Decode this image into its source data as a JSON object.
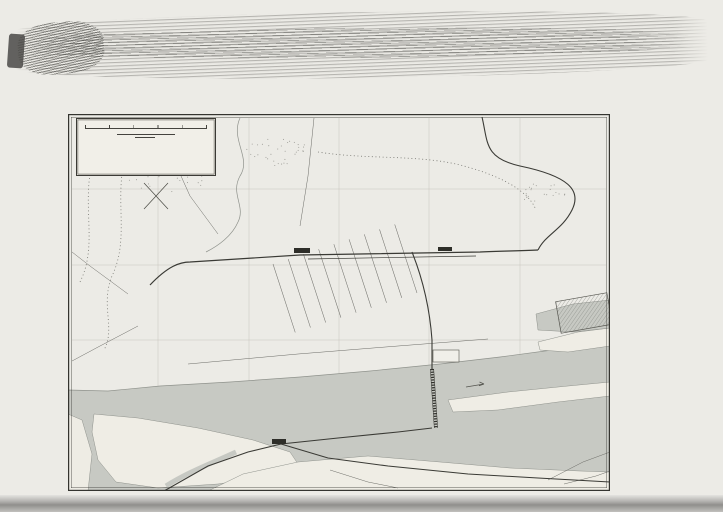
{
  "page": {
    "imprint": "Bibliographisches Institut in Leipzig."
  },
  "title_box": {
    "title": "UMGEBUNG v. MAINZ.",
    "scale_label": "Maßstab 1:25000",
    "scale_numbers": [
      "0",
      "200",
      "400",
      "600",
      "800",
      "1000"
    ],
    "scale_unit": "Mtr.",
    "kilometer_label": "1 Kilometer",
    "legend_tram": "Pferde- und Dampfstraßenbahn."
  },
  "border": {
    "top_letters": [
      "A",
      "B",
      "C",
      "D",
      "E",
      "F"
    ],
    "bottom_letters": [
      "A",
      "B",
      "C",
      "D",
      "E",
      "F"
    ],
    "left_numbers": [
      "1",
      "2",
      "3",
      "4",
      "5"
    ],
    "right_numbers": [
      "1",
      "2",
      "3",
      "4",
      "5"
    ],
    "top_label": "Zahlbach",
    "top_routes": [
      "n. Bretzenheim u. Marienborn",
      "n. Mombach",
      "n. Gonsenheim u. Finthen",
      "n. Budenheim"
    ],
    "bottom_routes": [
      "n. Frankfurt",
      "n. Wiesbaden u. Biebrich"
    ],
    "left_route": "n. Frankfurt u. Darmstadt"
  },
  "labels": [
    {
      "id": "zentral-bahnhof",
      "text": "Zentral-Bahnhof"
    },
    {
      "id": "gueter-bahnhof",
      "text": "Güter-Bahnhof"
    },
    {
      "id": "neustadt",
      "text": "Neustadt"
    },
    {
      "id": "gartenfeld",
      "text": "Gartenfeld"
    },
    {
      "id": "zitadelle",
      "text": "Zitadelle"
    },
    {
      "id": "theater",
      "text": "Theater"
    },
    {
      "id": "dom",
      "text": "Dom"
    },
    {
      "id": "rhein",
      "text": "RHEIN"
    },
    {
      "id": "strom",
      "text": "STROM"
    },
    {
      "id": "rhein-promenade",
      "text": "Rhein Promenade"
    },
    {
      "id": "trajekthof",
      "text": "Trajekthof"
    },
    {
      "id": "koeln-dampfer",
      "text": "Köln-Düsseldorfer Dampfer"
    },
    {
      "id": "niederl-dampfer",
      "text": "Niederländische Dampfer"
    },
    {
      "id": "eisenbruecke",
      "text": "Eisenbrücke"
    },
    {
      "id": "maar-aue",
      "text": "Maar-Aue"
    },
    {
      "id": "main",
      "text": "MAIN"
    },
    {
      "id": "peters-aue",
      "text": "Peters Aue"
    },
    {
      "id": "kastel",
      "text": "KASTEL"
    },
    {
      "id": "kastel-small",
      "text": "Kastel."
    },
    {
      "id": "taunus-bahnhof",
      "text": "Taunus Bahnh."
    },
    {
      "id": "kirche",
      "text": "Kirche"
    },
    {
      "id": "evang-k",
      "text": "Evang. K."
    },
    {
      "id": "frankfurter-thor",
      "text": "Frankfurter Thor"
    },
    {
      "id": "wiesbadener-thor",
      "text": "Wiesbadener Thor"
    },
    {
      "id": "sicherheitshafen-kastel",
      "text": "Sicherheitshafen"
    },
    {
      "id": "sicherheitshafen-mainz",
      "text": "Sicherheitshafen"
    },
    {
      "id": "floss-hafen",
      "text": "Sicherheits- und Floßhafen"
    },
    {
      "id": "ingelheimer-aue",
      "text": "Ingelheimer Aue"
    },
    {
      "id": "exerzier-platz",
      "text": "Exerzier Platz"
    },
    {
      "id": "hess-ludwigsbahn",
      "text": "Hessische Ludwigsbahn"
    },
    {
      "id": "hartenberg",
      "text": "Hartenberg"
    },
    {
      "id": "hartmuehle",
      "text": "Hartmühle"
    },
    {
      "id": "konserven-fabrik",
      "text": "Kgl. Konserven-Fabrik"
    },
    {
      "id": "mombacher-thor",
      "text": "Mombacher Thor"
    },
    {
      "id": "kaserne-1",
      "text": "Kaserne"
    },
    {
      "id": "kaserne-2",
      "text": "Kaserne"
    },
    {
      "id": "festungswerke",
      "text": "Festungswerke"
    },
    {
      "id": "gauthor",
      "text": "Gauthor"
    },
    {
      "id": "neue-anlage",
      "text": "Neue Anlage"
    },
    {
      "id": "fischthor",
      "text": "Fischthor"
    },
    {
      "id": "zollhafen",
      "text": "Zollhafen"
    },
    {
      "id": "mainbruecke",
      "text": "Mainbrücke"
    },
    {
      "id": "n-biebrich",
      "text": "n. Biebrich"
    },
    {
      "id": "n-wiesbaden",
      "text": "n. Wiesbaden"
    },
    {
      "id": "hess-ludwigsbahn-main",
      "text": "Hess. Ludwigsbahn"
    },
    {
      "id": "compass-s",
      "text": "S."
    },
    {
      "id": "compass-w",
      "text": "W."
    },
    {
      "id": "compass-o",
      "text": "O."
    },
    {
      "id": "compass-n",
      "text": "N."
    }
  ],
  "index": {
    "entries": [
      {
        "name": "Bahnhof-Platz",
        "ref": "C 2"
      },
      {
        "name": "Binger Thor",
        "ref": "C 2"
      },
      {
        "name": "Bischöfl. Palast",
        "ref": "B 3"
      },
      {
        "name": "Brand",
        "ref": "C 4"
      },
      {
        "name": "Dagobertstr.",
        "ref": "B 4"
      },
      {
        "name": "Deutschhaus-Pl.",
        "ref": "C 4"
      },
      {
        "name": "Dom",
        "ref": "B C 3"
      },
      {
        "name": "Eigelstein",
        "ref": "B 4"
      },
      {
        "name": "Emmeransstr.",
        "ref": "C 3"
      },
      {
        "name": "Feldbergstr.",
        "ref": "D 2"
      },
      {
        "name": "Fischthor",
        "ref": "C 4"
      },
      {
        "name": "Fort Karl",
        "ref": "B 2"
      },
      {
        "name": "Gallusthor",
        "ref": "B 4"
      },
      {
        "name": "Gauthor",
        "ref": "B 3"
      },
      {
        "name": "Gonsenheimer Thor",
        "ref": "B 1"
      },
      {
        "name": "Gr. Bleiche",
        "ref": "C 3"
      },
      {
        "name": "Großh. Palais",
        "ref": "C 4"
      },
      {
        "name": "Gutenberg-Pl.",
        "ref": "C 3"
      },
      {
        "name": "Gymnasium",
        "ref": "C 3"
      },
      {
        "name": "Hauptzollamt",
        "ref": "D 2"
      },
      {
        "name": "Justiz-Palast",
        "ref": "C 3"
      },
      {
        "name": "Kaiserstraße",
        "ref": "C D 2"
      },
      {
        "name": "Kaiserthor",
        "ref": "D 2"
      },
      {
        "name": "Karthause",
        "ref": "C 4"
      },
      {
        "name": "Kästrich",
        "ref": "B 3"
      },
      {
        "name": "Klarastraße",
        "ref": "B 3"
      },
      {
        "name": "Lauterenstr.",
        "ref": "C 4"
      },
      {
        "name": "Liebfrauen-Pl.",
        "ref": "C 3"
      },
      {
        "name": "Ludwigsstraße",
        "ref": "C 3"
      },
      {
        "name": "Markt",
        "ref": "C 3"
      },
      {
        "name": "Mathildenstr.",
        "ref": "C 2"
      },
      {
        "name": "Militär-Hospital",
        "ref": "B 4"
      },
      {
        "name": "Mombacher Thor",
        "ref": "C 1"
      },
      {
        "name": "Münsterplatz",
        "ref": "B 3"
      },
      {
        "name": "Neue Anlage",
        "ref": "A 4"
      },
      {
        "name": "Neuthor",
        "ref": "B 5"
      },
      {
        "name": "Pfaffengasse",
        "ref": "C 3"
      },
      {
        "name": "Post u. Telegraph",
        "ref": "C 3"
      },
      {
        "name": "Raimundithor",
        "ref": "C 2"
      },
      {
        "name": "Rhein-Allee",
        "ref": "C D 2"
      },
      {
        "name": "Rheinstraße",
        "ref": "C 4"
      },
      {
        "name": "Schillerplatz",
        "ref": "B 3"
      },
      {
        "name": "Schloß",
        "ref": "C 4"
      },
      {
        "name": "Schönborner Hof",
        "ref": "C 3"
      },
      {
        "name": "Schusterstraße",
        "ref": "C 3"
      },
      {
        "name": "Stadthalle",
        "ref": "D 3"
      },
      {
        "name": "Stadthaus",
        "ref": "C 3"
      },
      {
        "name": "Taunus-Bahnhof",
        "ref": "D 5"
      },
      {
        "name": "Theater",
        "ref": "C 3"
      },
      {
        "name": "Thiermarkt",
        "ref": "C 3"
      },
      {
        "name": "Universität",
        "ref": "C 3"
      },
      {
        "name": "Wallstraße",
        "ref": "B 2"
      },
      {
        "name": "Windmühlenberg",
        "ref": "B 4"
      },
      {
        "name": "Zahlbach",
        "ref": "A 2"
      },
      {
        "name": "Zentral-Bhf.",
        "ref": "C 1"
      },
      {
        "name": "Zeughaus",
        "ref": "C 4"
      },
      {
        "name": "Zitadelle",
        "ref": "B 4"
      }
    ]
  }
}
